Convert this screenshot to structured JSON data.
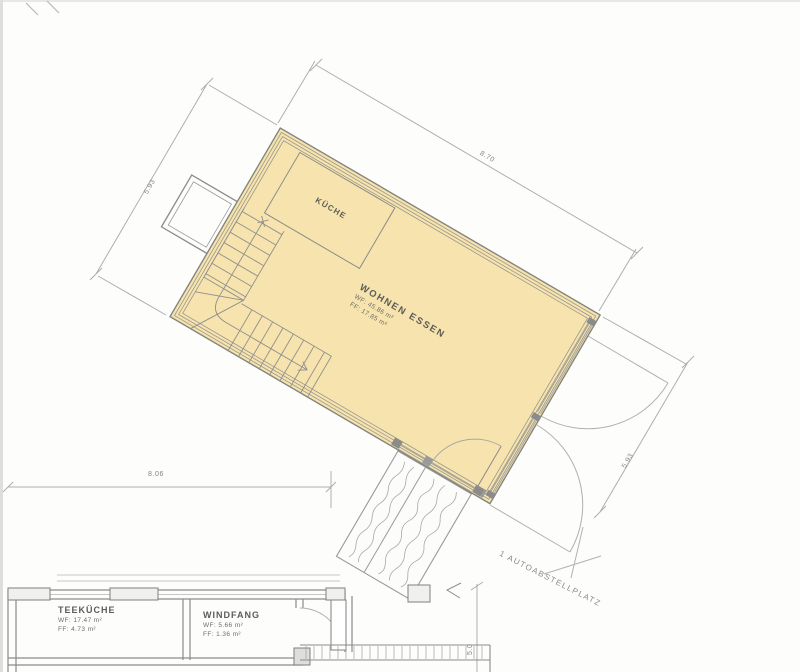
{
  "plan": {
    "main_room": {
      "name": "WOHNEN ESSEN",
      "area_line1": "WF: 45.86 m²",
      "area_line2": "FF: 17.85 m²"
    },
    "kitchen": {
      "name": "KÜCHE"
    },
    "tea_kitchen": {
      "name": "TEEKÜCHE",
      "area_line1": "WF: 17.47 m²",
      "area_line2": "FF: 4.73 m²"
    },
    "vestibule": {
      "name": "WINDFANG",
      "area_line1": "WF: 5.66 m²",
      "area_line2": "FF: 1.36 m²"
    },
    "parking_label": "1 AUTOABSTELLPLATZ",
    "dimensions": {
      "top": "8.70",
      "left": "5.93",
      "right": "5.93",
      "bottom": "8.06",
      "parking": "5.0"
    },
    "colors": {
      "room_highlight": "#f7e3ad",
      "wall_line": "#8b8b89",
      "dim_line": "#a8a8a6",
      "label_text": "#63635f"
    }
  }
}
